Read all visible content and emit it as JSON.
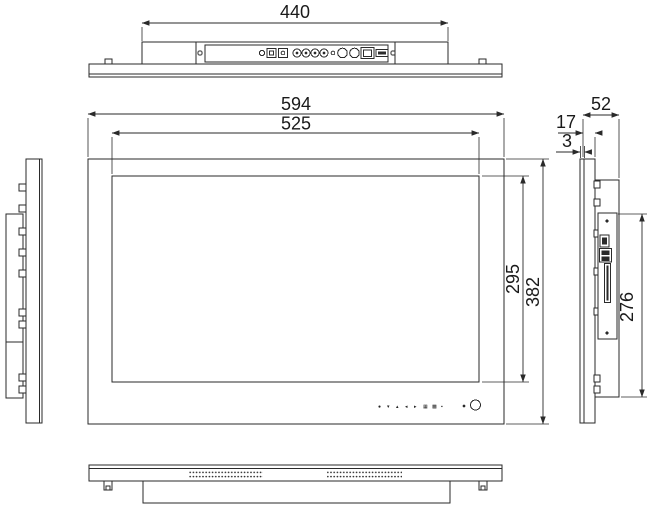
{
  "drawing": {
    "type": "technical-dimension-drawing",
    "subject": "open-frame-lcd-monitor",
    "units_implied": "mm",
    "dimensions": {
      "rear_module_width": "440",
      "front_outer_width": "594",
      "front_inner_width": "525",
      "front_inner_height": "295",
      "front_outer_height": "382",
      "side_total_depth": "52",
      "side_front_module_depth": "17",
      "side_bezel_thickness": "3",
      "side_rear_module_height": "276"
    },
    "views": {
      "top": "top-view-rear-connector-panel",
      "front": "front-view",
      "left": "left-side-view",
      "right": "right-side-view",
      "bottom": "bottom-view-vent-grilles"
    },
    "rear_ports": [
      "indicator-hole",
      "din-jack",
      "dc-jack",
      "rca-jack",
      "rca-jack",
      "rca-jack",
      "rca-jack",
      "ir-hole",
      "bnc-jack",
      "bnc-jack",
      "ethernet-port",
      "usb-port"
    ],
    "side_ports": [
      "hdmi-port",
      "dual-usb-port",
      "card-slot"
    ],
    "controls": [
      "●",
      "▾",
      "▴",
      "◂",
      "▸",
      "▦",
      "▩",
      "▪"
    ],
    "colors": {
      "line": "#2a2a2a",
      "background": "#ffffff"
    }
  }
}
